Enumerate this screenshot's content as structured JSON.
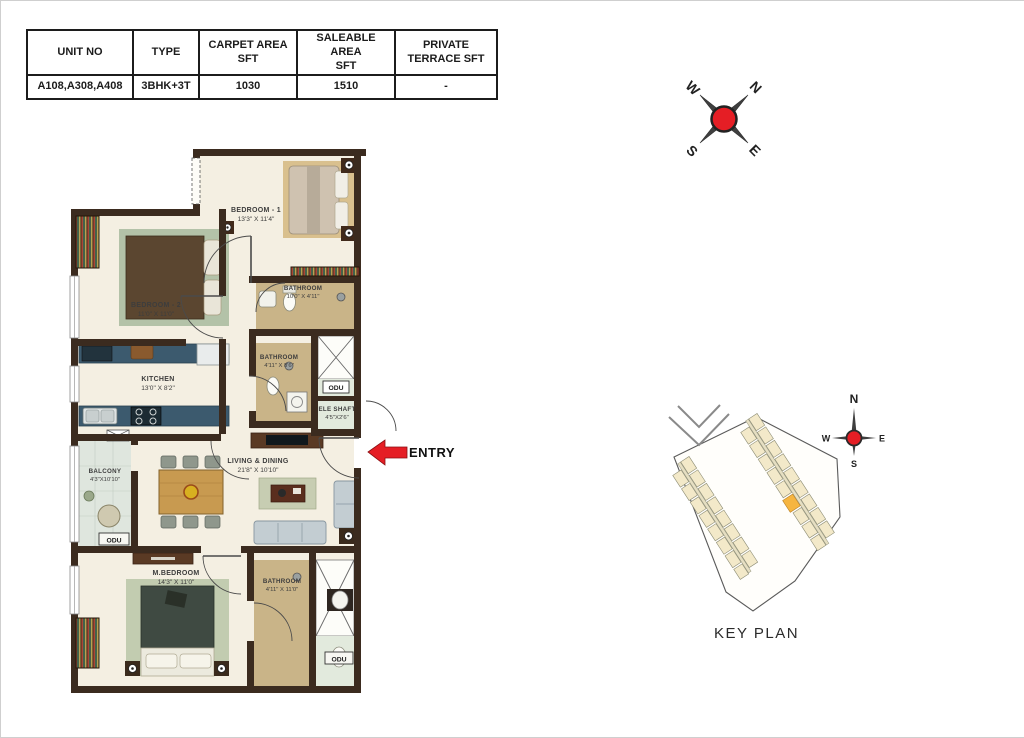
{
  "table": {
    "headers": [
      "UNIT NO",
      "TYPE",
      "CARPET AREA\nSFT",
      "SALEABLE AREA\nSFT",
      "PRIVATE\nTERRACE  SFT"
    ],
    "row": [
      "A108,A308,A408",
      "3BHK+3T",
      "1030",
      "1510",
      "-"
    ]
  },
  "rooms": {
    "bedroom1": {
      "name": "BEDROOM - 1",
      "dims": "13'3\" X 11'4\""
    },
    "bedroom2": {
      "name": "BEDROOM - 2",
      "dims": "11'0\" X 11'0\""
    },
    "bathroom1": {
      "name": "BATHROOM",
      "dims": "10'0\" X 4'11\""
    },
    "bathroom2": {
      "name": "BATHROOM",
      "dims": "4'11\" X 8'6\""
    },
    "kitchen": {
      "name": "KITCHEN",
      "dims": "13'0\" X 8'2\""
    },
    "ele_shaft": {
      "name": "ELE SHAFT",
      "dims": "4'5\"X2'6\""
    },
    "living": {
      "name": "LIVING & DINING",
      "dims": "21'8\" X 10'10\""
    },
    "balcony": {
      "name": "BALCONY",
      "dims": "4'3\"X10'10\""
    },
    "mbedroom": {
      "name": "M.BEDROOM",
      "dims": "14'3\" X 11'0\""
    },
    "bathroom3": {
      "name": "BATHROOM",
      "dims": "4'11\" X 11'0\""
    }
  },
  "labels": {
    "entry": "ENTRY",
    "odu": "ODU",
    "key_plan_title": "KEY PLAN"
  },
  "compass": {
    "n": "N",
    "e": "E",
    "s": "S",
    "w": "W"
  },
  "colors": {
    "wall": "#3b2b1f",
    "floor_cream": "#f4efe2",
    "bath_floor": "#c9b488",
    "kitchen_counter": "#3c5a6e",
    "balcony_floor": "#dfe6de",
    "shaft_green": "#e2eadd",
    "accent_red": "#e51e25",
    "keyplan_unit": "#f3e9c9",
    "keyplan_highlight": "#f6b540"
  }
}
